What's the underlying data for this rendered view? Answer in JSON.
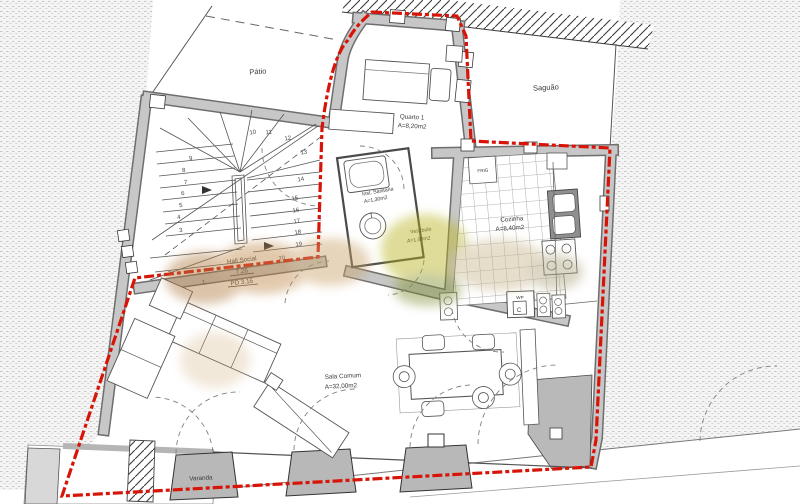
{
  "plan": {
    "rooms": {
      "patio": {
        "label": "Pátio"
      },
      "saguao": {
        "label": "Saguão"
      },
      "quarto1": {
        "label": "Quarto 1",
        "area": "A=8,20m2"
      },
      "inst_sanitaria": {
        "label": "Inst. Sanitária",
        "area": "A=1,30m2"
      },
      "vestibulo": {
        "label": "Vestíbulo",
        "area": "A=1,90m2"
      },
      "cozinha": {
        "label": "Cozinha",
        "area": "A=8,40m2"
      },
      "hall_social": {
        "label": "Hall Social",
        "area": "7.26",
        "ceiling": "PD 3.16"
      },
      "sala_comum": {
        "label": "Sala Comum",
        "area": "A=32,00m2"
      },
      "varanda": {
        "label": "Varanda"
      }
    },
    "appliances": {
      "fridge": "FRIG",
      "water_heater": "WP",
      "cylinder": "C"
    },
    "stairs": {
      "numbers": [
        "1",
        "2",
        "3",
        "4",
        "5",
        "6",
        "7",
        "8",
        "9",
        "10",
        "11",
        "12",
        "13",
        "14",
        "15",
        "16",
        "17",
        "18",
        "19",
        "20"
      ]
    },
    "colors": {
      "boundary_red": "#d81408",
      "wall_gray": "#c7c7c7",
      "wall_edge": "#6e6e6e",
      "line": "#3a3a3a"
    }
  }
}
